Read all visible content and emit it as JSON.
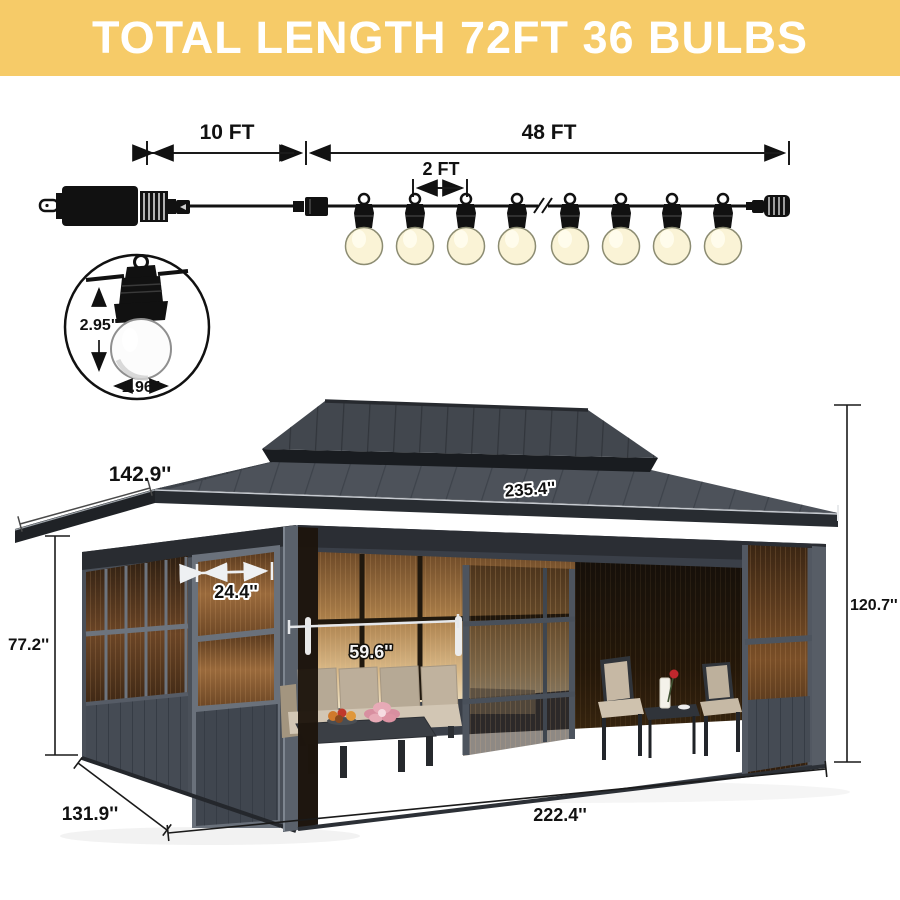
{
  "banner": {
    "title": "TOTAL LENGTH 72FT 36 BULBS",
    "background_color": "#F6CB68",
    "text_color": "#FFFFFF"
  },
  "string_lights": {
    "lead_length_label": "10 FT",
    "lit_length_label": "48 FT",
    "bulb_spacing_label": "2 FT",
    "visible_bulb_count": 8,
    "component_icons": {
      "left_end": "power-plug-icon",
      "middle": "inline-connector-icon",
      "break": "wire-break-icon",
      "right_end": "end-connector-icon"
    }
  },
  "bulb_detail": {
    "height_label": "2.95\"",
    "diameter_label": "1.96\""
  },
  "gazebo": {
    "dimensions": {
      "roof_side_length": "142.9''",
      "roof_front_length": "235.4''",
      "door_panel_width": "24.4''",
      "door_opening_width": "59.6''",
      "wall_height": "77.2''",
      "total_height": "120.7''",
      "base_depth": "131.9''",
      "base_front_width": "222.4''"
    }
  },
  "colors": {
    "banner_yellow": "#F6CB68",
    "bulb_warm_white": "#FAF3D6",
    "roof_gray": "#4B5058",
    "frame_gray": "#59606A",
    "glass_amber": "#8A5F36",
    "cushion_tan": "#C2B3A0"
  }
}
